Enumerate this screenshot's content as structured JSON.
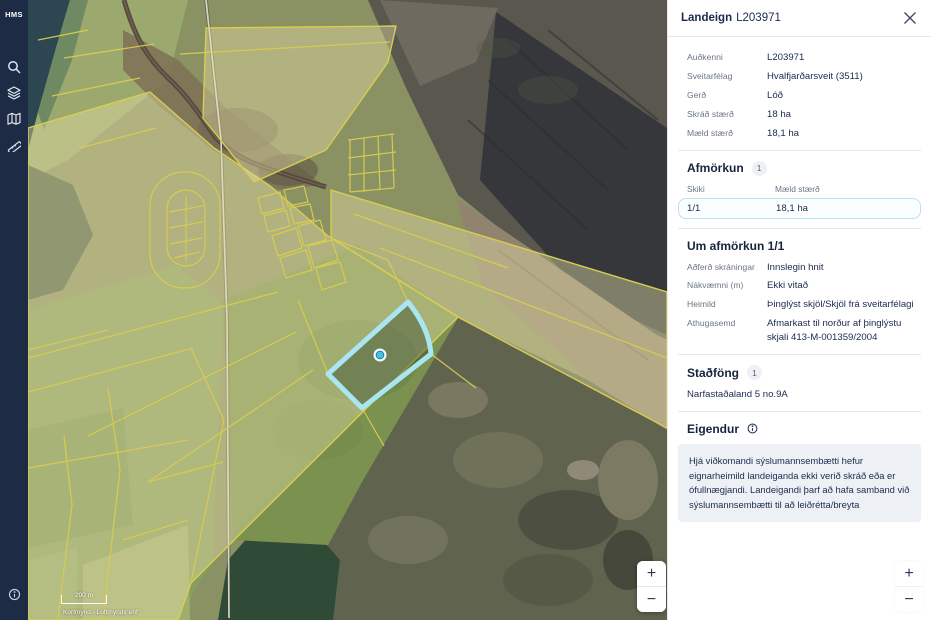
{
  "sidebar": {
    "logo": "HMS",
    "icons": [
      {
        "name": "search"
      },
      {
        "name": "layers"
      },
      {
        "name": "map-book"
      },
      {
        "name": "measure"
      }
    ],
    "bottom_icon": "info"
  },
  "map": {
    "scale_bar_label": "200 m",
    "attribution": "Kortmynd - Loftmyndir ehf",
    "zoom_in_label": "+",
    "zoom_out_label": "−",
    "selected_parcel_color": "#a9e6f2",
    "parcel_line_color": "#d8cd4f"
  },
  "panel": {
    "title_bold": "Landeign",
    "title_id": "L203971",
    "fields": [
      {
        "label": "Auðkenni",
        "value": "L203971"
      },
      {
        "label": "Sveitarfélag",
        "value": "Hvalfjarðarsveit (3511)"
      },
      {
        "label": "Gerð",
        "value": "Lóð"
      },
      {
        "label": "Skráð stærð",
        "value": "18 ha"
      },
      {
        "label": "Mæld stærð",
        "value": "18,1 ha"
      }
    ],
    "afmorkun": {
      "heading": "Afmörkun",
      "badge": "1",
      "col1": "Skiki",
      "col2": "Mæld stærð",
      "row": {
        "skiki": "1/1",
        "maeld": "18,1 ha"
      }
    },
    "um_afmorkun": {
      "heading": "Um afmörkun 1/1",
      "fields": [
        {
          "label": "Aðferð skráningar",
          "value": "Innslegin hnit"
        },
        {
          "label": "Nákvæmni (m)",
          "value": "Ekki vitað"
        },
        {
          "label": "Heimild",
          "value": "Þinglýst skjöl/Skjöl frá sveitarfélagi"
        },
        {
          "label": "Athugasemd",
          "value": "Afmarkast til norður af þinglýstu skjali 413-M-001359/2004"
        }
      ]
    },
    "stadfong": {
      "heading": "Staðföng",
      "badge": "1",
      "address": "Narfastaðaland 5 no.9A"
    },
    "eigendur": {
      "heading": "Eigendur",
      "notice": "Hjá viðkomandi sýslumannsembætti hefur eignarheimild landeiganda ekki verið skráð eða er ófullnægjandi. Landeigandi þarf að hafa samband við sýslumannsembætti til að leiðrétta/breyta"
    },
    "zoom_in_label": "+",
    "zoom_out_label": "−"
  }
}
